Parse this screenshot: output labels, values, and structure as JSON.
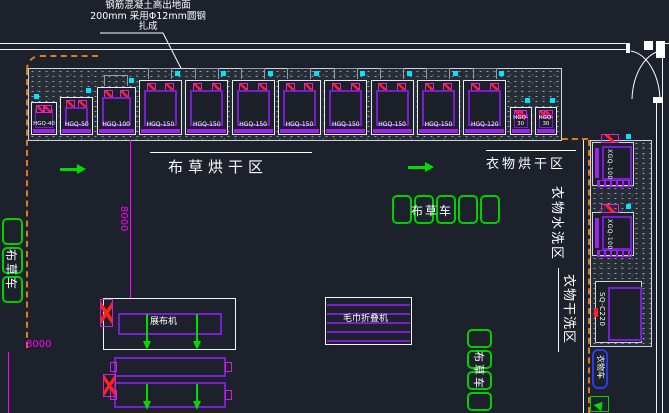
{
  "annotation": {
    "line1": "钢筋混凝土高出地面",
    "line2": "200mm 采用Φ12mm圆钢",
    "line3": "扎成"
  },
  "zones": {
    "linen_drying": "布草烘干区",
    "clothes_drying": "衣物烘干区",
    "clothes_washing": "衣物水洗区",
    "clothes_dry_cleaning": "衣物干洗区"
  },
  "dryers": [
    {
      "model": "HGQ-40",
      "size": "xs"
    },
    {
      "model": "HGQ-50",
      "size": "s"
    },
    {
      "model": "HGQ-100",
      "size": "m"
    },
    {
      "model": "HGQ-150",
      "size": "l"
    },
    {
      "model": "HGQ-150",
      "size": "l"
    },
    {
      "model": "HGQ-150",
      "size": "l"
    },
    {
      "model": "HGQ-150",
      "size": "l"
    },
    {
      "model": "HGQ-150",
      "size": "l"
    },
    {
      "model": "HGQ-150",
      "size": "l"
    },
    {
      "model": "HGQ-150",
      "size": "l"
    },
    {
      "model": "HGQ-120",
      "size": "l"
    },
    {
      "model": "HGQ-30",
      "size": "xr"
    },
    {
      "model": "HGQ-30",
      "size": "xr"
    }
  ],
  "carts": {
    "label_middle": "布草车",
    "label_left": "布草车",
    "label_bottom_right": "布草车"
  },
  "bottom_machines": {
    "spreader": "展布机",
    "towel_folder": "毛巾折叠机"
  },
  "right_units": {
    "washer_top": "XGQ-100",
    "washer_bottom": "XGQ-100",
    "dry_cleaner": "SQ-C220",
    "clothes_cart": "衣物车"
  },
  "dimensions": {
    "vertical_8000": "8000",
    "left_8000": "8000"
  },
  "colors": {
    "background": "#1c212b",
    "boundary_orange": "#e07c18",
    "entity_purple": "#7a1fd0",
    "detail_magenta": "#ff00ff",
    "cart_green": "#00cf00",
    "chip_cyan": "#00e5ff",
    "wall_white": "#f2f4f7"
  }
}
